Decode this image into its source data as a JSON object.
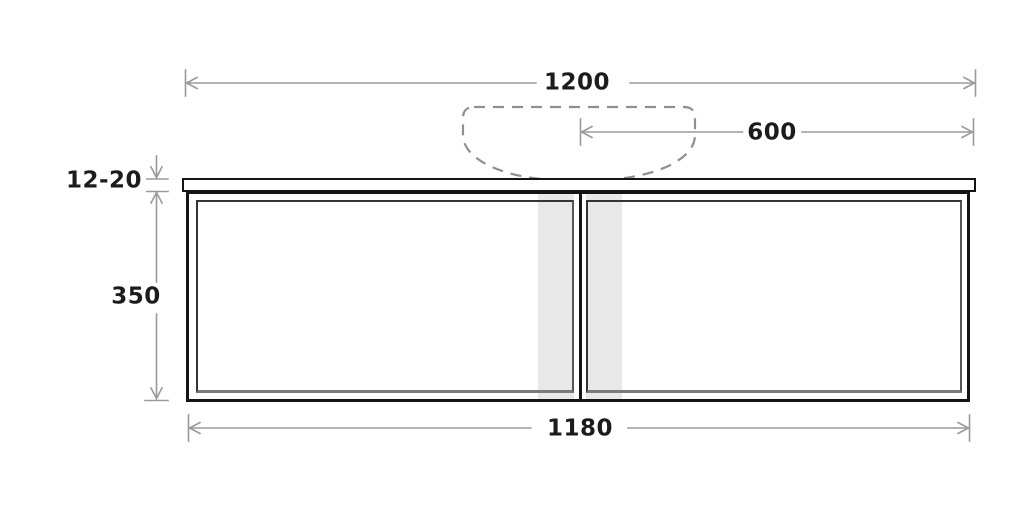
{
  "diagram": {
    "type": "technical-drawing",
    "subject": "wall-hung vanity cabinet with countertop basin — front elevation",
    "dimensions": {
      "countertop_width": {
        "label": "1200",
        "orientation": "horizontal",
        "position": "top"
      },
      "basin_center_offset": {
        "label": "600",
        "orientation": "horizontal",
        "position": "upper-right"
      },
      "countertop_thickness": {
        "label": "12-20",
        "orientation": "vertical",
        "position": "left-upper"
      },
      "cabinet_height": {
        "label": "350",
        "orientation": "vertical",
        "position": "left"
      },
      "cabinet_width": {
        "label": "1180",
        "orientation": "horizontal",
        "position": "bottom"
      }
    },
    "elements": {
      "basin_outline": "dashed bowl shape centered above countertop",
      "doors": 2,
      "shaded_strips": 2
    },
    "colors": {
      "background": "#ffffff",
      "dimension_line": "#9a9a9a",
      "label_text": "#1c1c1c",
      "cabinet_outline": "#141414",
      "panel_line": "#343434",
      "panel_shadow": "#7a7a7a",
      "shaded_strip": "#e8e8e8",
      "basin_dash": "#8f8f8f"
    }
  }
}
